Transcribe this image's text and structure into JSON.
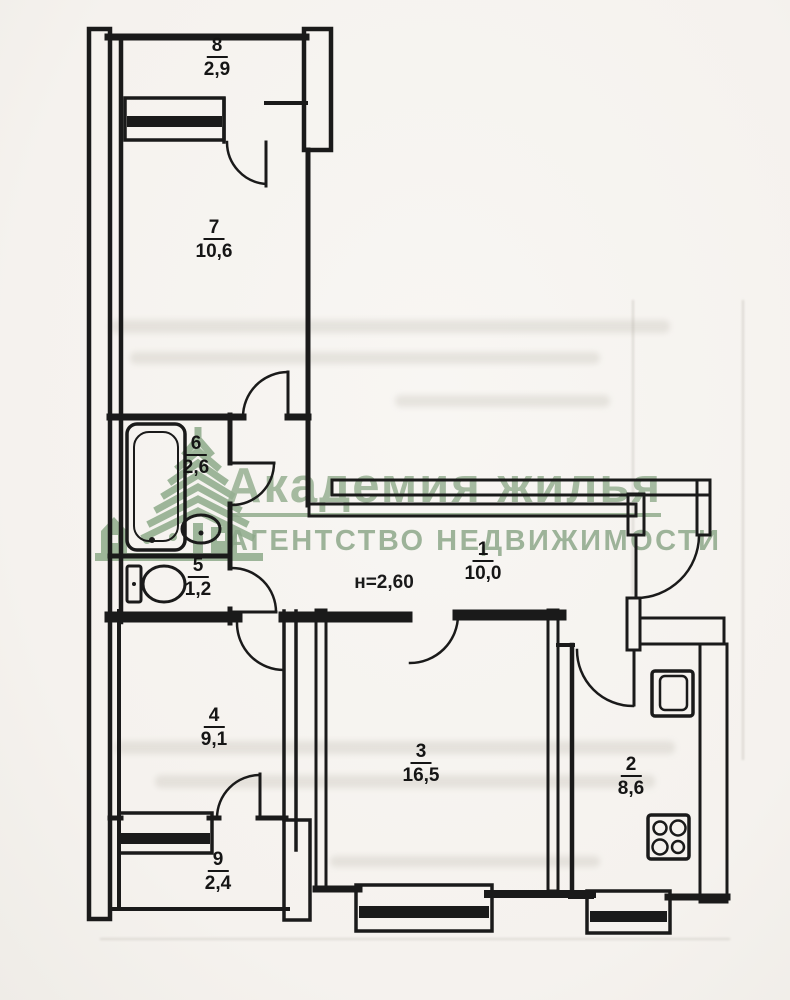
{
  "colors": {
    "paper": "#f6f3ef",
    "ink": "#1a1a1a",
    "watermark_green": "#94ae90"
  },
  "watermark": {
    "title": "Академия жилья",
    "subtitle": "АГЕНТСТВО НЕДВИЖИМОСТИ",
    "logo": "tree-and-building-logo"
  },
  "plan": {
    "height_note": "н=2,60",
    "rooms": [
      {
        "number": "1",
        "area": "10,0"
      },
      {
        "number": "2",
        "area": "8,6"
      },
      {
        "number": "3",
        "area": "16,5"
      },
      {
        "number": "4",
        "area": "9,1"
      },
      {
        "number": "5",
        "area": "1,2"
      },
      {
        "number": "6",
        "area": "2,6"
      },
      {
        "number": "7",
        "area": "10,6"
      },
      {
        "number": "8",
        "area": "2,9"
      },
      {
        "number": "9",
        "area": "2,4"
      }
    ],
    "fixtures": [
      {
        "icon": "bathtub-icon",
        "in_room": "6"
      },
      {
        "icon": "sink-icon",
        "in_room": "6"
      },
      {
        "icon": "toilet-icon",
        "in_room": "5"
      },
      {
        "icon": "fridge-icon",
        "in_room": "2"
      },
      {
        "icon": "stove-icon",
        "in_room": "2"
      }
    ],
    "window_count": 4,
    "door_count": 9
  }
}
